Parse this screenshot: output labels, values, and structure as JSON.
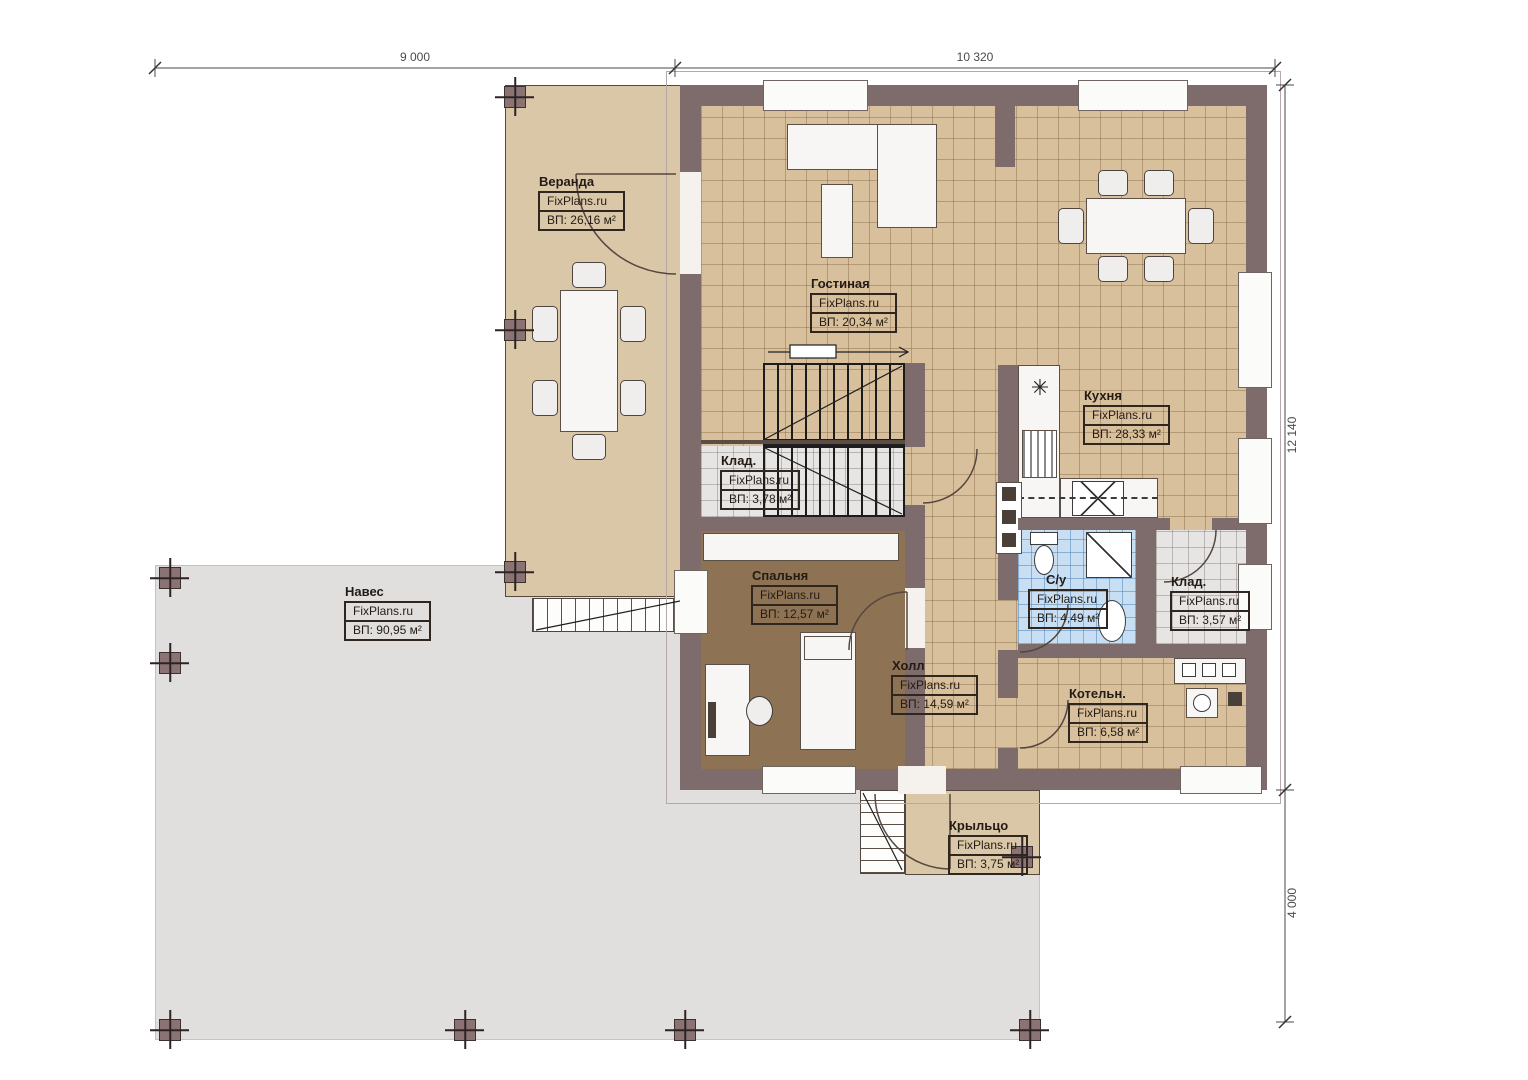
{
  "brand": "FixPlans.ru",
  "rooms": {
    "veranda": {
      "name": "Веранда",
      "area": "ВП: 26,16 м²"
    },
    "living": {
      "name": "Гостиная",
      "area": "ВП: 20,34 м²"
    },
    "kitchen": {
      "name": "Кухня",
      "area": "ВП: 28,33 м²"
    },
    "storage1": {
      "name": "Клад.",
      "area": "ВП: 3,78 м²"
    },
    "bedroom": {
      "name": "Спальня",
      "area": "ВП: 12,57 м²"
    },
    "hall": {
      "name": "Холл",
      "area": "ВП: 14,59 м²"
    },
    "bathroom": {
      "name": "С/у",
      "area": "ВП: 4,49 м²"
    },
    "storage2": {
      "name": "Клад.",
      "area": "ВП: 3,57 м²"
    },
    "boiler": {
      "name": "Котельн.",
      "area": "ВП: 6,58 м²"
    },
    "canopy": {
      "name": "Навес",
      "area": "ВП: 90,95 м²"
    },
    "porch": {
      "name": "Крыльцо",
      "area": "ВП: 3,75 м²"
    }
  },
  "dimensions": {
    "top_left": "9 000",
    "top_right": "10 320",
    "right_upper": "12 140",
    "right_lower": "4 000"
  },
  "colors": {
    "wall": "#7e6b6b",
    "floor_tile": "#d9c09c",
    "veranda": "#d9c7a8",
    "canopy": "#e0dfdd",
    "bedroom_floor": "#8d7354",
    "bathroom_tile": "#c8def2"
  }
}
